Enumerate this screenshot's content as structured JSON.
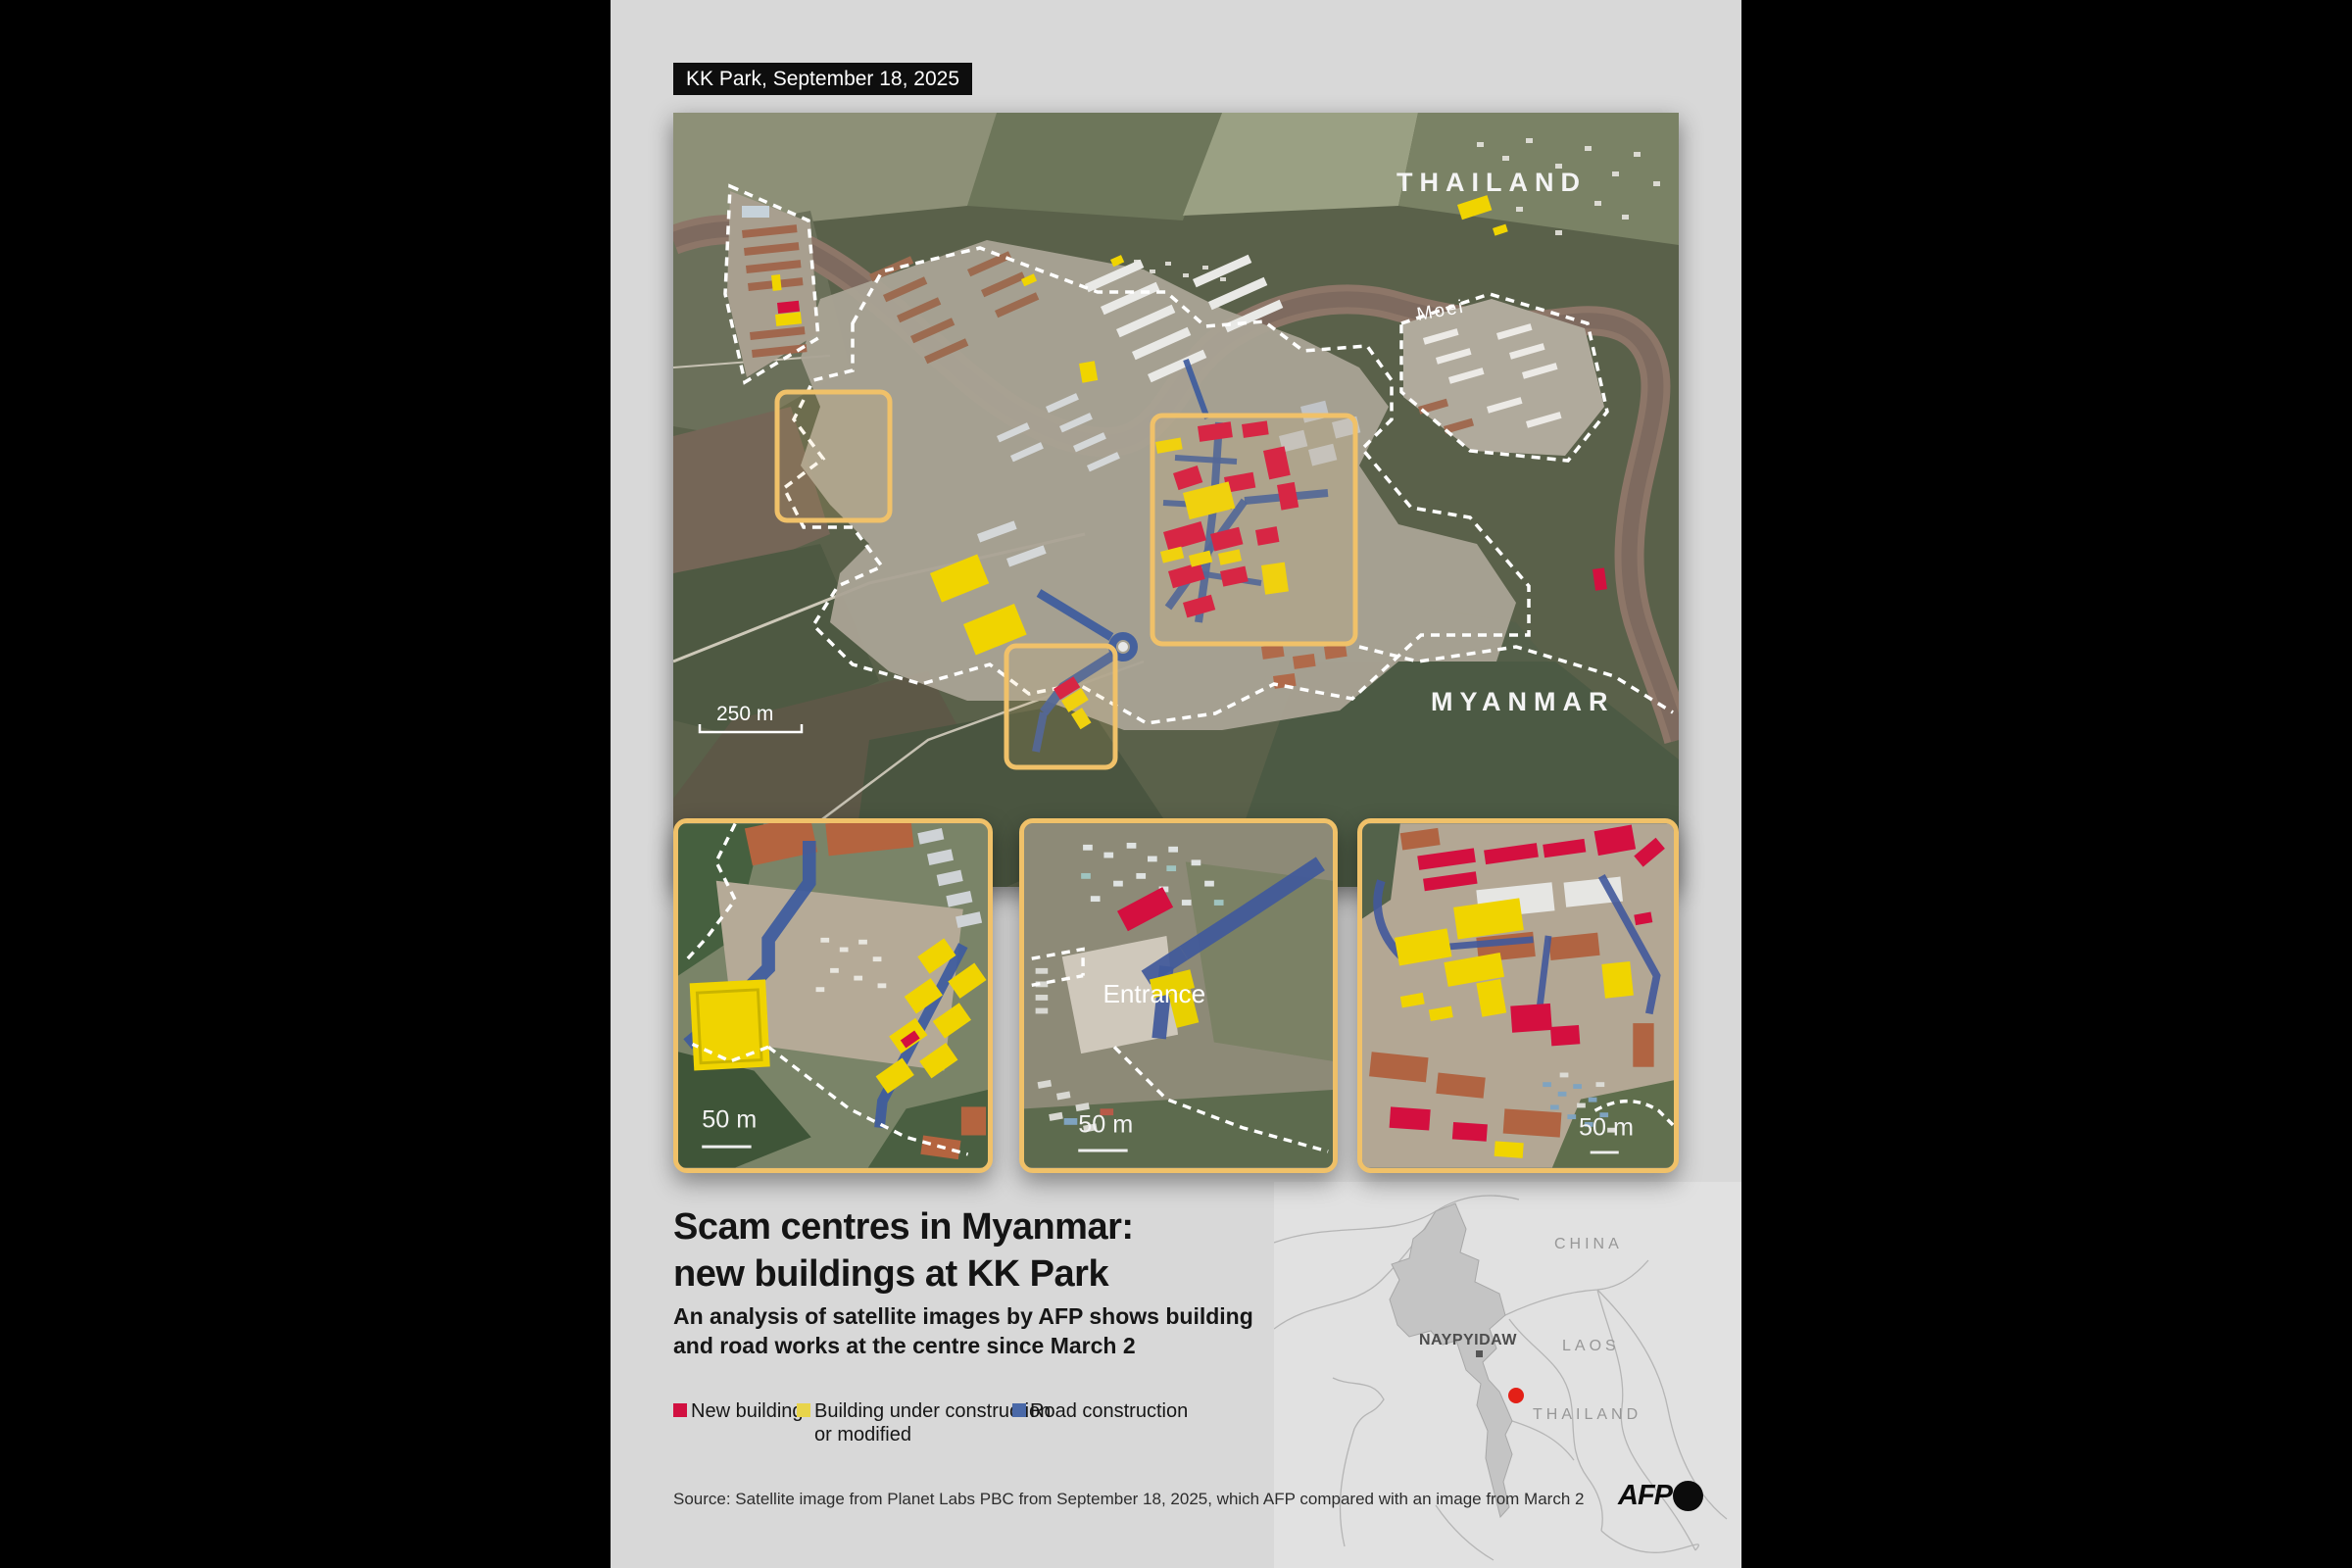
{
  "header": {
    "label": "KK Park, September 18, 2025"
  },
  "map": {
    "country_top": "THAILAND",
    "country_bottom": "MYANMAR",
    "river_label": "Moei",
    "scale_label": "250 m"
  },
  "insets": [
    {
      "scale_label": "50 m"
    },
    {
      "scale_label": "50 m",
      "entrance_label": "Entrance"
    },
    {
      "scale_label": "50 m"
    }
  ],
  "title": {
    "line1": "Scam centres in Myanmar:",
    "line2": "new buildings at KK Park"
  },
  "subtitle": {
    "line1": "An analysis of satellite images by AFP shows building",
    "line2": "and road works at the centre since March 2"
  },
  "legend": [
    {
      "label": "New building",
      "color": "#d11040"
    },
    {
      "label": "Building under construction",
      "label2": "or modified",
      "color": "#e8d44a"
    },
    {
      "label": "Road construction",
      "color": "#4a69a8"
    }
  ],
  "source": "Source: Satellite image from Planet Labs PBC from September 18, 2025, which AFP compared with an image from March 2",
  "locator": {
    "china": "CHINA",
    "capital": "NAYPYIDAW",
    "laos": "LAOS",
    "thailand": "THAILAND",
    "logo": "AFP"
  },
  "colors": {
    "page_bg": "#d8d8d8",
    "new_building": "#d40f3f",
    "under_construction": "#f0d400",
    "road": "#3d5b9e",
    "zoom_box": "#f0c169",
    "boundary_dash": "#ffffff",
    "river": "#8d7668",
    "locator_country_fill": "#c4c4c4",
    "locator_dot": "#e32017"
  }
}
